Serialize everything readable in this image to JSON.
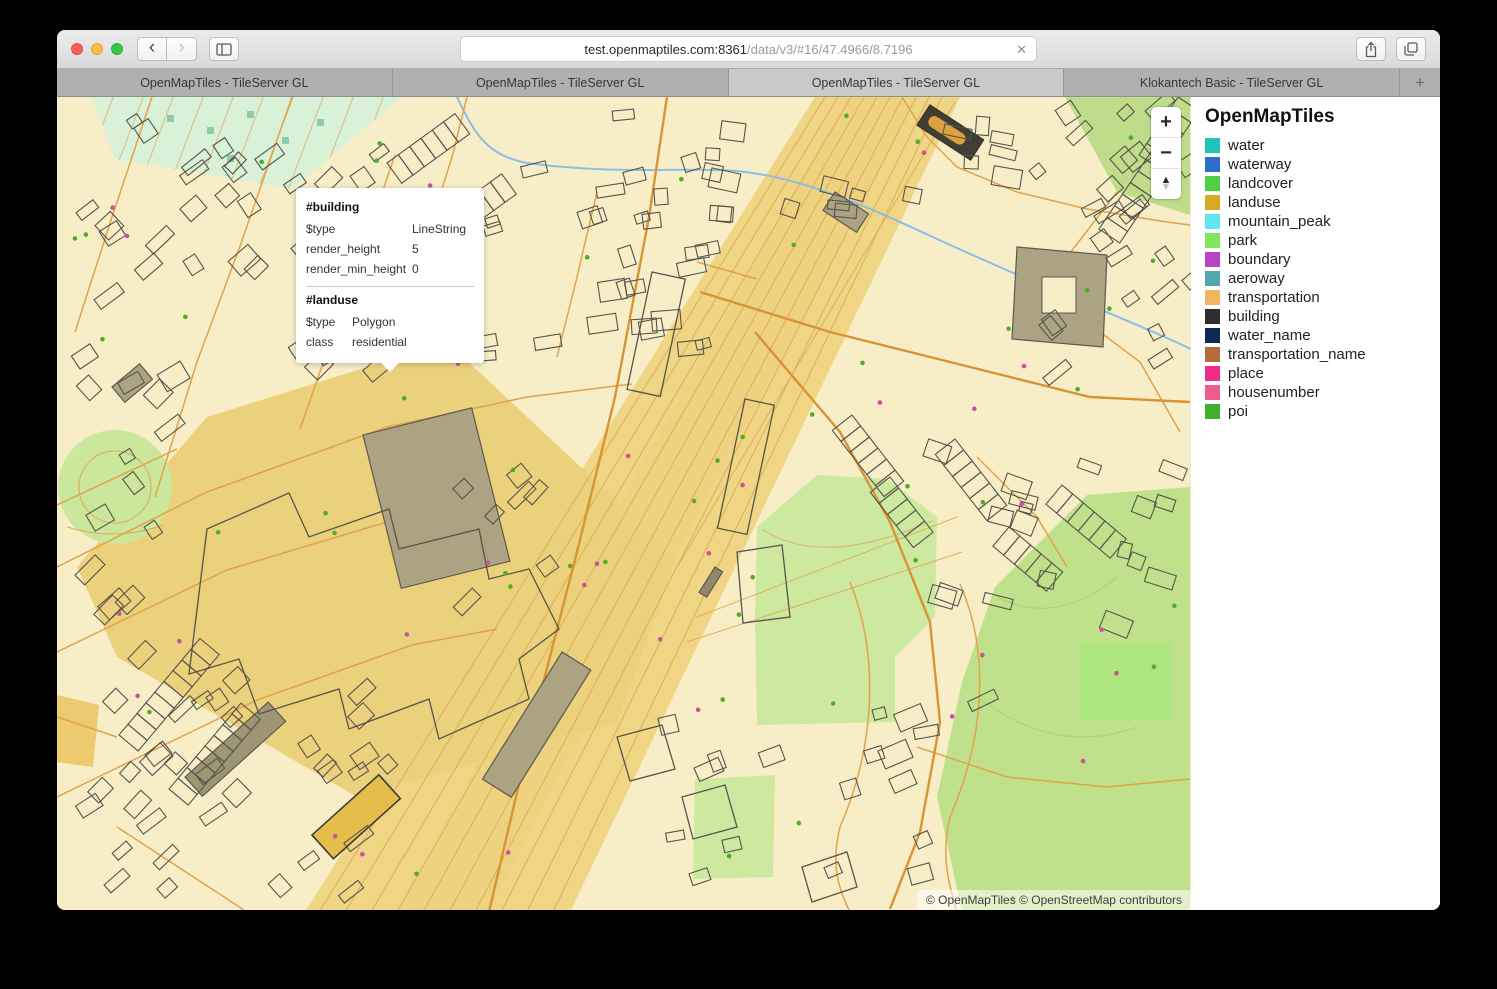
{
  "browser": {
    "url_host": "test.openmaptiles.com:8361",
    "url_path": "/data/v3/#16/47.4966/8.7196",
    "icons": {
      "back": "‹",
      "forward": "›",
      "clear_url": "✕",
      "new_tab": "+"
    },
    "traffic_colors": {
      "close": "#fc5b57",
      "minimize": "#fdbe41",
      "zoom": "#34c84a"
    }
  },
  "tabs": [
    {
      "label": "OpenMapTiles - TileServer GL",
      "active": false
    },
    {
      "label": "OpenMapTiles - TileServer GL",
      "active": false
    },
    {
      "label": "OpenMapTiles - TileServer GL",
      "active": true
    },
    {
      "label": "Klokantech Basic - TileServer GL",
      "active": false
    }
  ],
  "map": {
    "controls": {
      "zoom_in": "+",
      "zoom_out": "−",
      "compass_up": "▲",
      "compass_down": "▼"
    },
    "attribution": "© OpenMapTiles © OpenStreetMap contributors",
    "popup": {
      "sections": [
        {
          "title": "#building",
          "rows": [
            {
              "key": "$type",
              "value": "LineString"
            },
            {
              "key": "render_height",
              "value": "5"
            },
            {
              "key": "render_min_height",
              "value": "0"
            }
          ]
        },
        {
          "title": "#landuse",
          "rows": [
            {
              "key": "$type",
              "value": "Polygon"
            },
            {
              "key": "class",
              "value": "residential"
            }
          ]
        }
      ]
    },
    "colors": {
      "base": "#f7eec8",
      "rail_corridor": "#efd584",
      "industrial": "#ecd17c",
      "park": "#cde9a0",
      "park_dark": "#c0e18c",
      "park_light": "#ade57e",
      "landcover_mint": "#d8f1d7",
      "road": "#e1a24a",
      "road_major": "#d89434",
      "building_stroke": "#57534b",
      "building_olive": "#aba381",
      "water_line": "#8cbde7",
      "poi_dot": "#4fae27",
      "housenumber_dot": "#cb519c",
      "highlight_building": "#e4bd4a"
    }
  },
  "legend": {
    "title": "OpenMapTiles",
    "items": [
      {
        "label": "water",
        "color": "#21c4bc"
      },
      {
        "label": "waterway",
        "color": "#2e6ecb"
      },
      {
        "label": "landcover",
        "color": "#4ecf45"
      },
      {
        "label": "landuse",
        "color": "#d9a921"
      },
      {
        "label": "mountain_peak",
        "color": "#5fe7f1"
      },
      {
        "label": "park",
        "color": "#81e55f"
      },
      {
        "label": "boundary",
        "color": "#b746c7"
      },
      {
        "label": "aeroway",
        "color": "#53a6ad"
      },
      {
        "label": "transportation",
        "color": "#f1b65f"
      },
      {
        "label": "building",
        "color": "#2e2e2e"
      },
      {
        "label": "water_name",
        "color": "#0e2a50"
      },
      {
        "label": "transportation_name",
        "color": "#b56c3d"
      },
      {
        "label": "place",
        "color": "#ef2b85"
      },
      {
        "label": "housenumber",
        "color": "#ec5d8a"
      },
      {
        "label": "poi",
        "color": "#41ae2d"
      }
    ]
  }
}
